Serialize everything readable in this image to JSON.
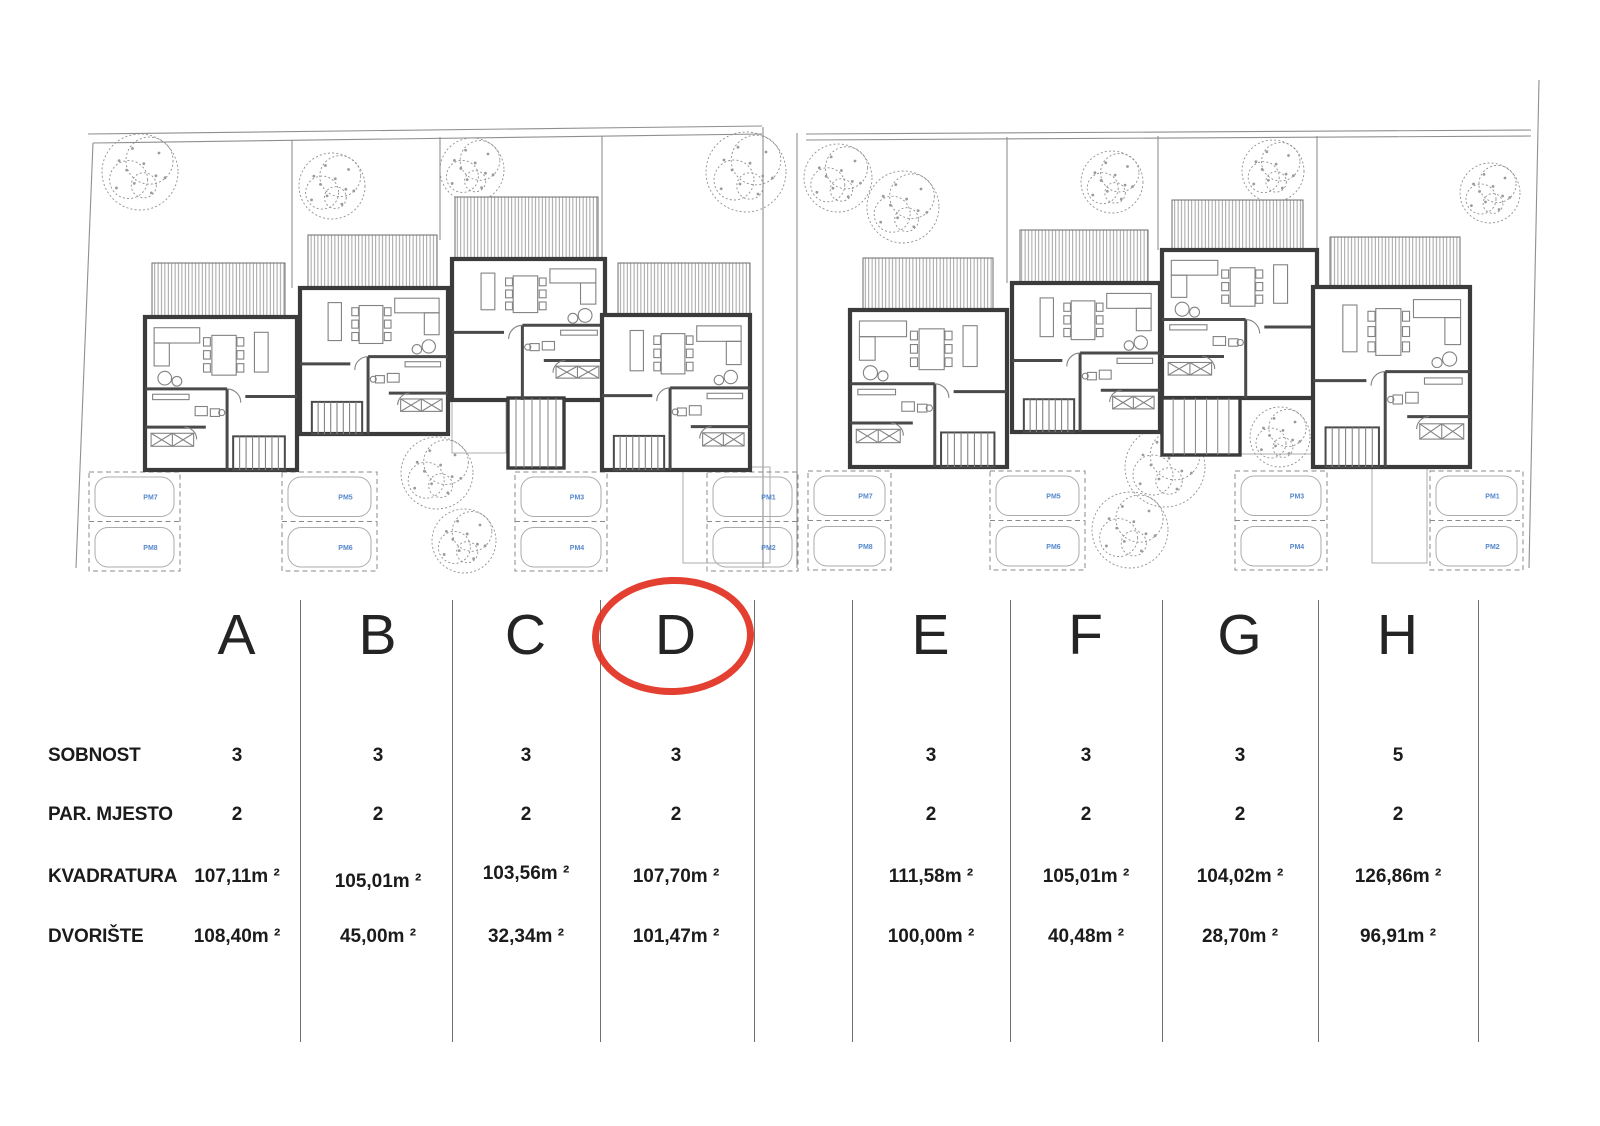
{
  "table": {
    "row_labels": [
      "SOBNOST",
      "PAR. MJESTO",
      "KVADRATURA",
      "DVORIŠTE"
    ],
    "units": [
      {
        "letter": "A",
        "sobnost": "3",
        "par_mjesto": "2",
        "kvadratura": "107,11m ²",
        "dvoriste": "108,40m ²"
      },
      {
        "letter": "B",
        "sobnost": "3",
        "par_mjesto": "2",
        "kvadratura": "105,01m ²",
        "dvoriste": "45,00m ²"
      },
      {
        "letter": "C",
        "sobnost": "3",
        "par_mjesto": "2",
        "kvadratura": "103,56m ²",
        "dvoriste": "32,34m ²"
      },
      {
        "letter": "D",
        "sobnost": "3",
        "par_mjesto": "2",
        "kvadratura": "107,70m ²",
        "dvoriste": "101,47m ²"
      },
      {
        "letter": "E",
        "sobnost": "3",
        "par_mjesto": "2",
        "kvadratura": "111,58m ²",
        "dvoriste": "100,00m ²"
      },
      {
        "letter": "F",
        "sobnost": "3",
        "par_mjesto": "2",
        "kvadratura": "105,01m ²",
        "dvoriste": "40,48m ²"
      },
      {
        "letter": "G",
        "sobnost": "3",
        "par_mjesto": "2",
        "kvadratura": "104,02m ²",
        "dvoriste": "28,70m ²"
      },
      {
        "letter": "H",
        "sobnost": "5",
        "par_mjesto": "2",
        "kvadratura": "126,86m ²",
        "dvoriste": "96,91m ²"
      }
    ],
    "highlighted_unit": "D"
  },
  "colors": {
    "accent_red": "#e2301f",
    "parking_blue": "#5588cc",
    "wall": "#3b3b3b",
    "boundary_gray": "#8f8f8f"
  },
  "site_plan": {
    "boundaries": [
      [
        [
          88,
          134
        ],
        [
          762,
          126
        ]
      ],
      [
        [
          93,
          143
        ],
        [
          762,
          134
        ]
      ],
      [
        [
          806,
          134
        ],
        [
          1531,
          130
        ]
      ],
      [
        [
          806,
          140
        ],
        [
          1531,
          136
        ]
      ],
      [
        [
          93,
          143
        ],
        [
          76,
          568
        ]
      ],
      [
        [
          1539,
          80
        ],
        [
          1529,
          568
        ]
      ]
    ],
    "garden_dividers": [
      [
        292,
        140,
        292,
        288
      ],
      [
        440,
        137,
        440,
        240
      ],
      [
        602,
        136,
        602,
        263
      ],
      [
        763,
        127,
        763,
        568
      ],
      [
        797,
        133,
        797,
        568
      ],
      [
        1007,
        137,
        1007,
        283
      ],
      [
        1158,
        136,
        1158,
        250
      ],
      [
        1317,
        136,
        1317,
        287
      ]
    ],
    "terraces": [
      [
        452,
        400,
        54,
        53
      ],
      [
        1240,
        398,
        76,
        56
      ],
      [
        683,
        467,
        87,
        96
      ],
      [
        1372,
        467,
        55,
        96
      ]
    ],
    "houses": [
      {
        "id": "A",
        "roof": [
          152,
          263,
          133,
          54
        ],
        "body": [
          145,
          317,
          152,
          153
        ],
        "mirror": false
      },
      {
        "id": "B",
        "roof": [
          308,
          235,
          129,
          53
        ],
        "body": [
          300,
          288,
          148,
          146
        ],
        "mirror": true
      },
      {
        "id": "C",
        "roof": [
          455,
          197,
          143,
          62
        ],
        "body": [
          452,
          259,
          153,
          141
        ],
        "ext": [
          508,
          398,
          56,
          70
        ],
        "noStairs": true,
        "mirror": true
      },
      {
        "id": "D",
        "roof": [
          618,
          263,
          132,
          52
        ],
        "body": [
          602,
          315,
          148,
          155
        ],
        "mirror": true
      },
      {
        "id": "E",
        "roof": [
          863,
          258,
          130,
          52
        ],
        "body": [
          850,
          310,
          157,
          157
        ],
        "mirror": false
      },
      {
        "id": "F",
        "roof": [
          1020,
          230,
          128,
          53
        ],
        "body": [
          1012,
          283,
          148,
          149
        ],
        "mirror": true
      },
      {
        "id": "G",
        "roof": [
          1172,
          200,
          131,
          50
        ],
        "body": [
          1162,
          250,
          155,
          148
        ],
        "ext": [
          1162,
          398,
          78,
          57
        ],
        "noStairs": true,
        "mirror": false
      },
      {
        "id": "H",
        "roof": [
          1330,
          237,
          130,
          50
        ],
        "body": [
          1313,
          287,
          157,
          180
        ],
        "mirror": true
      }
    ],
    "trees": [
      [
        140,
        172,
        38
      ],
      [
        332,
        186,
        33
      ],
      [
        472,
        170,
        32
      ],
      [
        746,
        172,
        40
      ],
      [
        437,
        473,
        36
      ],
      [
        464,
        541,
        32
      ],
      [
        838,
        178,
        34
      ],
      [
        903,
        207,
        36
      ],
      [
        1112,
        182,
        31
      ],
      [
        1273,
        171,
        31
      ],
      [
        1490,
        193,
        30
      ],
      [
        1165,
        467,
        40
      ],
      [
        1130,
        530,
        38
      ],
      [
        1280,
        437,
        30
      ]
    ],
    "parking": [
      {
        "x": 89,
        "y": 472,
        "w": 91,
        "h": 99,
        "top": "PM7",
        "bottom": "PM8"
      },
      {
        "x": 282,
        "y": 472,
        "w": 95,
        "h": 99,
        "top": "PM5",
        "bottom": "PM6"
      },
      {
        "x": 515,
        "y": 472,
        "w": 92,
        "h": 99,
        "top": "PM3",
        "bottom": "PM4"
      },
      {
        "x": 707,
        "y": 472,
        "w": 91,
        "h": 99,
        "top": "PM1",
        "bottom": "PM2"
      },
      {
        "x": 808,
        "y": 471,
        "w": 83,
        "h": 99,
        "top": "PM7",
        "bottom": "PM8"
      },
      {
        "x": 990,
        "y": 471,
        "w": 95,
        "h": 99,
        "top": "PM5",
        "bottom": "PM6"
      },
      {
        "x": 1235,
        "y": 471,
        "w": 92,
        "h": 99,
        "top": "PM3",
        "bottom": "PM4"
      },
      {
        "x": 1430,
        "y": 471,
        "w": 93,
        "h": 99,
        "top": "PM1",
        "bottom": "PM2"
      }
    ]
  }
}
